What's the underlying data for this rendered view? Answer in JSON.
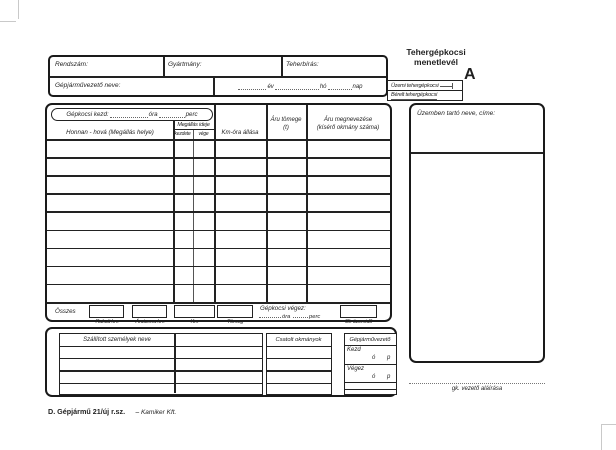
{
  "ink": "#1f1f1f",
  "paper": "#ffffff",
  "title": {
    "line1": "Tehergépkocsi",
    "line2": "menetlevél",
    "series_letter": "A"
  },
  "type_box": {
    "option1": "Üzemi tehergépkocsi",
    "option2": "Bérelt tehergépkocsi"
  },
  "vehicle_header": {
    "plate_label": "Rendszám:",
    "make_label": "Gyártmány:",
    "capacity_label": "Teherbírás:",
    "driver_label": "Gépjárművezető neve:",
    "year_suffix": "év",
    "month_suffix": "hó",
    "day_suffix": "nap"
  },
  "operator_box": {
    "label": "Üzemben tartó neve, címe:"
  },
  "trip_table": {
    "start_label": "Gépkocsi kezd:",
    "hour_suffix": "óra",
    "minute_suffix": "perc",
    "columns": {
      "route": "Honnan - hová (Megállás helye)",
      "stop_time": "Megállás ideje",
      "stop_start": "kezdete",
      "stop_end": "vége",
      "odometer": "Km-óra állása",
      "weight_l1": "Áru tömege",
      "weight_l2": "(t)",
      "cargo_l1": "Áru megnevezése",
      "cargo_l2": "(kísérő okmány száma)"
    },
    "body_rows": 9,
    "totals": {
      "label": "Összes",
      "box_labels": [
        "Rakott km",
        "Árutonna km",
        "Km",
        "Tömeg"
      ],
      "end_label": "Gépkocsi végez:",
      "operating_label": "Gk üzemidő"
    }
  },
  "bottom": {
    "passengers_header": "Szállított személyek neve",
    "passengers_rows": 4,
    "documents_header": "Csatolt okmányok",
    "documents_rows": 4,
    "driver_header": "Gépjárművezető",
    "start_label": "Kezd",
    "end_label": "Végez",
    "hour_abbr": "ó",
    "minute_abbr": "p"
  },
  "signature_label": "gk. vezető aláírása",
  "footer": {
    "form_code": "D. Gépjármű 21/új r.sz.",
    "publisher": "– Kamiker Kft."
  }
}
